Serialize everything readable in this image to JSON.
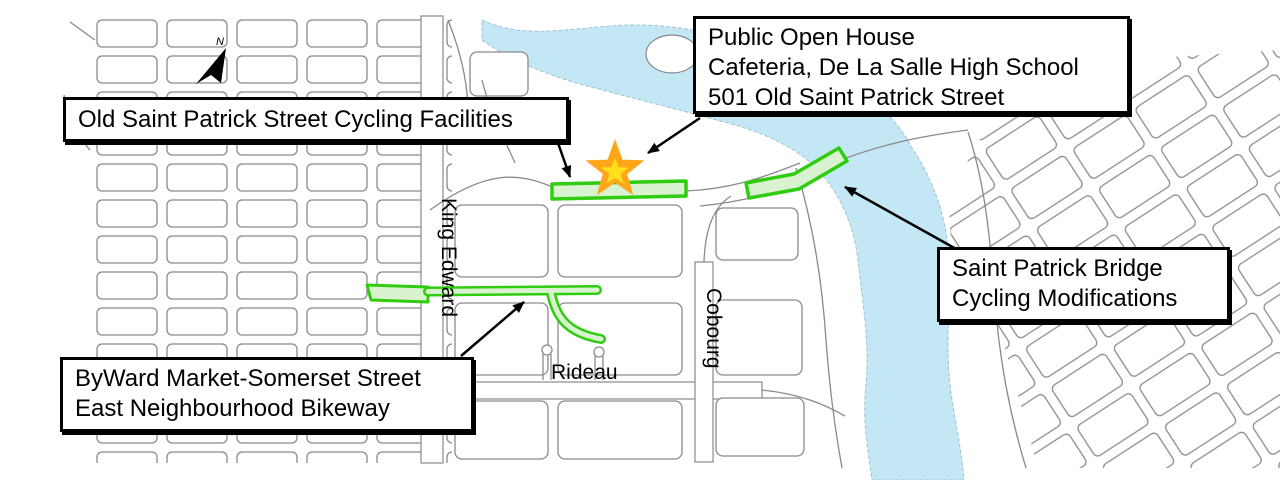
{
  "map": {
    "kind": "public-consultation cycling map",
    "colors": {
      "background": "#ffffff",
      "street": "#8a8a8a",
      "river": "#c4e7f5",
      "river_edge": "#9fc3d4",
      "highlight_stroke": "#2fcc0f",
      "highlight_fill": "#d9f2cf",
      "star_outer": "#ffa61a",
      "star_inner": "#ffdf1a",
      "callout_border": "#000000",
      "arrow": "#000000"
    }
  },
  "callouts": [
    {
      "name": "old-saint-patrick-callout",
      "lines": [
        "Old Saint Patrick Street Cycling Facilities"
      ]
    },
    {
      "name": "public-open-house-callout",
      "lines": [
        "Public Open House",
        "Cafeteria, De La Salle High School",
        "501 Old Saint Patrick Street"
      ]
    },
    {
      "name": "saint-patrick-bridge-callout",
      "lines": [
        "Saint Patrick Bridge",
        "Cycling Modifications"
      ]
    },
    {
      "name": "byward-bikeway-callout",
      "lines": [
        "ByWard Market-Somerset Street",
        "East Neighbourhood Bikeway"
      ]
    }
  ],
  "street_labels": [
    {
      "text": "King Edward",
      "orientation": "vertical"
    },
    {
      "text": "Cobourg",
      "orientation": "vertical"
    },
    {
      "text": "Rideau",
      "orientation": "horizontal"
    }
  ],
  "markers": [
    {
      "name": "open-house-star",
      "type": "star"
    },
    {
      "name": "north-arrow",
      "type": "compass",
      "label": "N"
    }
  ]
}
